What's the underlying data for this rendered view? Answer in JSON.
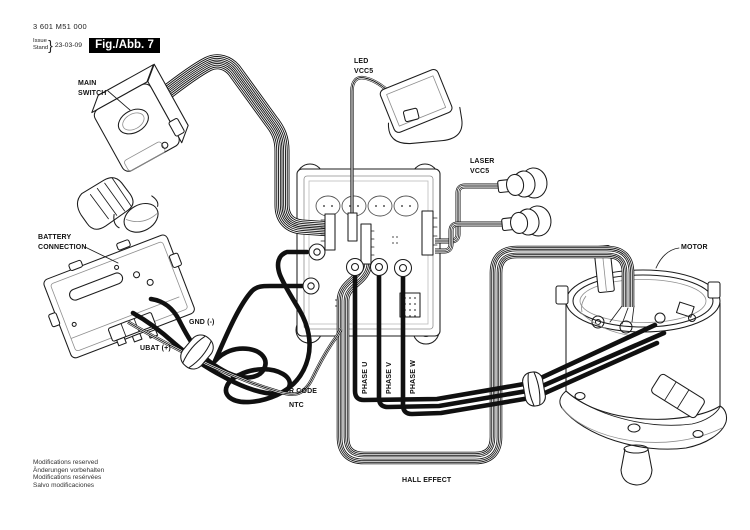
{
  "page": {
    "background": "#ffffff",
    "ink_color": "#1a1a1a"
  },
  "header": {
    "part_number": "3 601 M51 000",
    "issue_label": "Issue",
    "stand_label": "Stand",
    "issue_date": "23-03-09",
    "figure_label": "Fig./Abb. 7",
    "figure_box_bg": "#000000",
    "figure_box_fg": "#ffffff"
  },
  "callouts": {
    "main_switch_line1": "MAIN",
    "main_switch_line2": "SWITCH",
    "led_line1": "LED",
    "led_line2": "VCC5",
    "laser_line1": "LASER",
    "laser_line2": "VCC5",
    "battery_line1": "BATTERY",
    "battery_line2": "CONNECTION",
    "motor": "MOTOR",
    "gnd": "GND (-)",
    "ubat": "UBAT (+)",
    "r_code": "R CODE",
    "ntc": "NTC",
    "phase_u": "PHASE U",
    "phase_v": "PHASE V",
    "phase_w": "PHASE W",
    "hall_effect": "HALL EFFECT"
  },
  "footer": {
    "line1": "Modifications reserved",
    "line2": "Änderungen vorbehalten",
    "line3": "Modifications resérvées",
    "line4": "Salvo modificaciones"
  }
}
